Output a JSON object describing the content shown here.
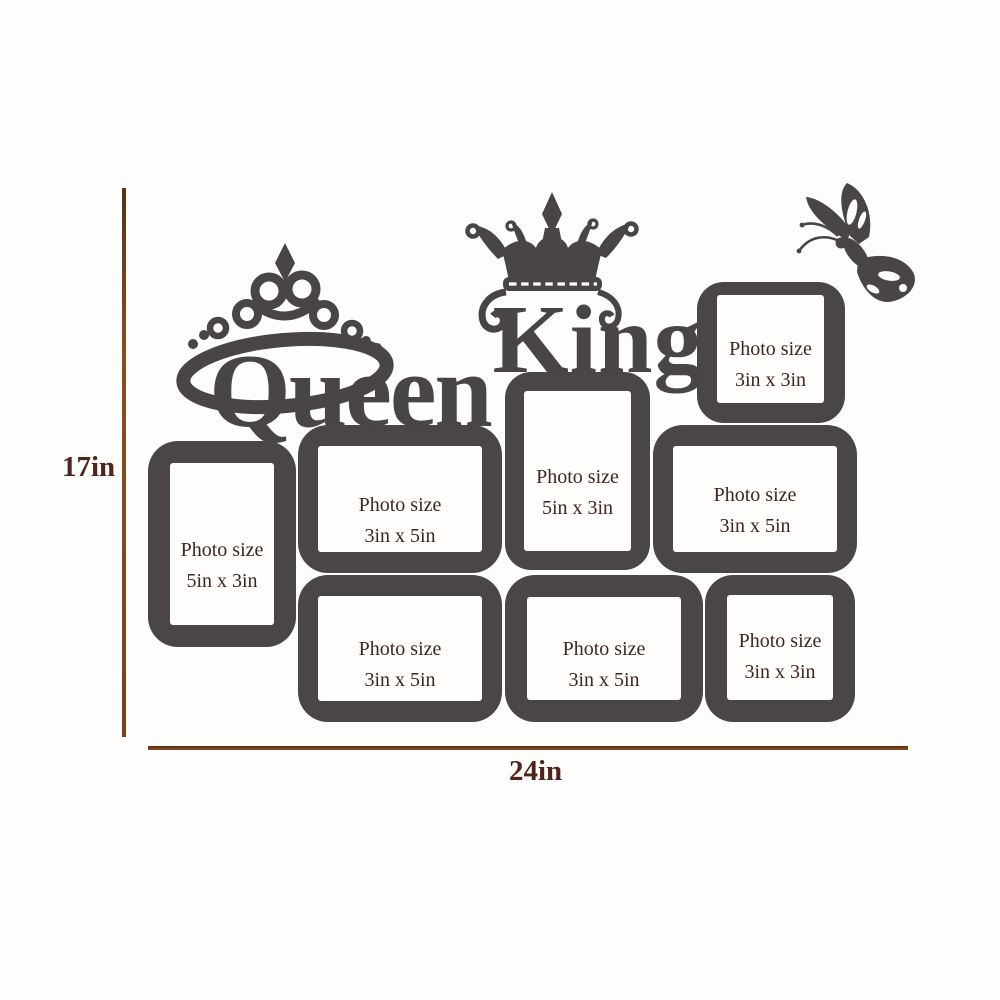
{
  "colors": {
    "frame": "#4a4647",
    "photo_window": "#fffefd",
    "label_text": "#3e2621",
    "dimension_line": "#7a421d",
    "dimension_text": "#4e241b",
    "background": "#fdfdfc"
  },
  "dimension_annotations": {
    "height_label": "17in",
    "width_label": "24in"
  },
  "decorations": {
    "queen_word": "Queen",
    "king_word": "King",
    "icons": [
      "tiara-icon",
      "crown-icon",
      "butterfly-icon"
    ]
  },
  "frames": [
    {
      "name": "left-portrait",
      "line1": "Photo size",
      "line2": "5in x 3in"
    },
    {
      "name": "top-middle-landscape",
      "line1": "Photo size",
      "line2": "3in x 5in"
    },
    {
      "name": "center-portrait",
      "line1": "Photo size",
      "line2": "5in x 3in"
    },
    {
      "name": "middle-right-landscape",
      "line1": "Photo size",
      "line2": "3in x 5in"
    },
    {
      "name": "top-right-square",
      "line1": "Photo size",
      "line2": "3in x 3in"
    },
    {
      "name": "bottom-left-landscape",
      "line1": "Photo size",
      "line2": "3in x 5in"
    },
    {
      "name": "bottom-center-landscape",
      "line1": "Photo size",
      "line2": "3in x 5in"
    },
    {
      "name": "bottom-right-square",
      "line1": "Photo size",
      "line2": "3in x 3in"
    }
  ]
}
